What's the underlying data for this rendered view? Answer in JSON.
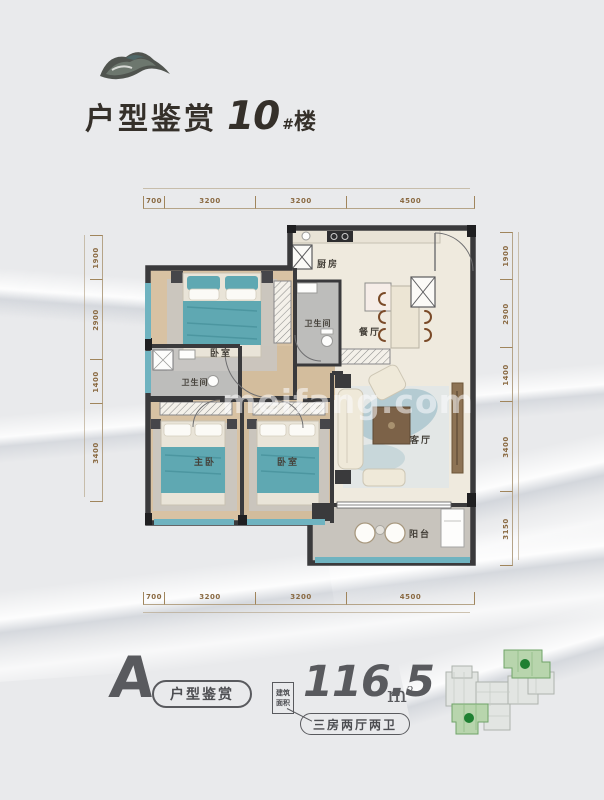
{
  "header": {
    "title": "户型鉴赏",
    "building_number": "10",
    "building_hash": "#",
    "building_suffix": "楼"
  },
  "watermark": "meifang.com",
  "plan": {
    "dims_top": [
      "700",
      "3200",
      "3200",
      "4500"
    ],
    "dims_bottom": [
      "700",
      "3200",
      "3200",
      "4500"
    ],
    "dims_left": [
      "1900",
      "2900",
      "1400",
      "3400"
    ],
    "dims_right": [
      "1900",
      "2900",
      "1400",
      "3400",
      "3150"
    ],
    "rooms": {
      "bedroom_top": "卧室",
      "bath_top": "卫生间",
      "kitchen": "厨房",
      "dining": "餐厅",
      "bath_mid": "卫生间",
      "master_bedroom": "主卧",
      "bedroom_bottom": "卧室",
      "living": "客厅",
      "balcony": "阳台"
    }
  },
  "footer": {
    "unit_letter": "A",
    "unit_pill": "户型鉴赏",
    "area_label_line1": "建筑",
    "area_label_line2": "面积",
    "area_value": "116.5",
    "area_unit": "m",
    "area_unit_sup": "2",
    "layout_badge": "三房两厅两卫"
  },
  "colors": {
    "background": "#e9eaec",
    "wall": "#3a3a3c",
    "window_teal": "#6fb3c0",
    "bed_teal": "#5fa8b2",
    "dimension_text": "#8a6a42",
    "title_text": "#35302a",
    "footer_gray": "#595a5e",
    "keyplan_green": "#1f8032"
  }
}
